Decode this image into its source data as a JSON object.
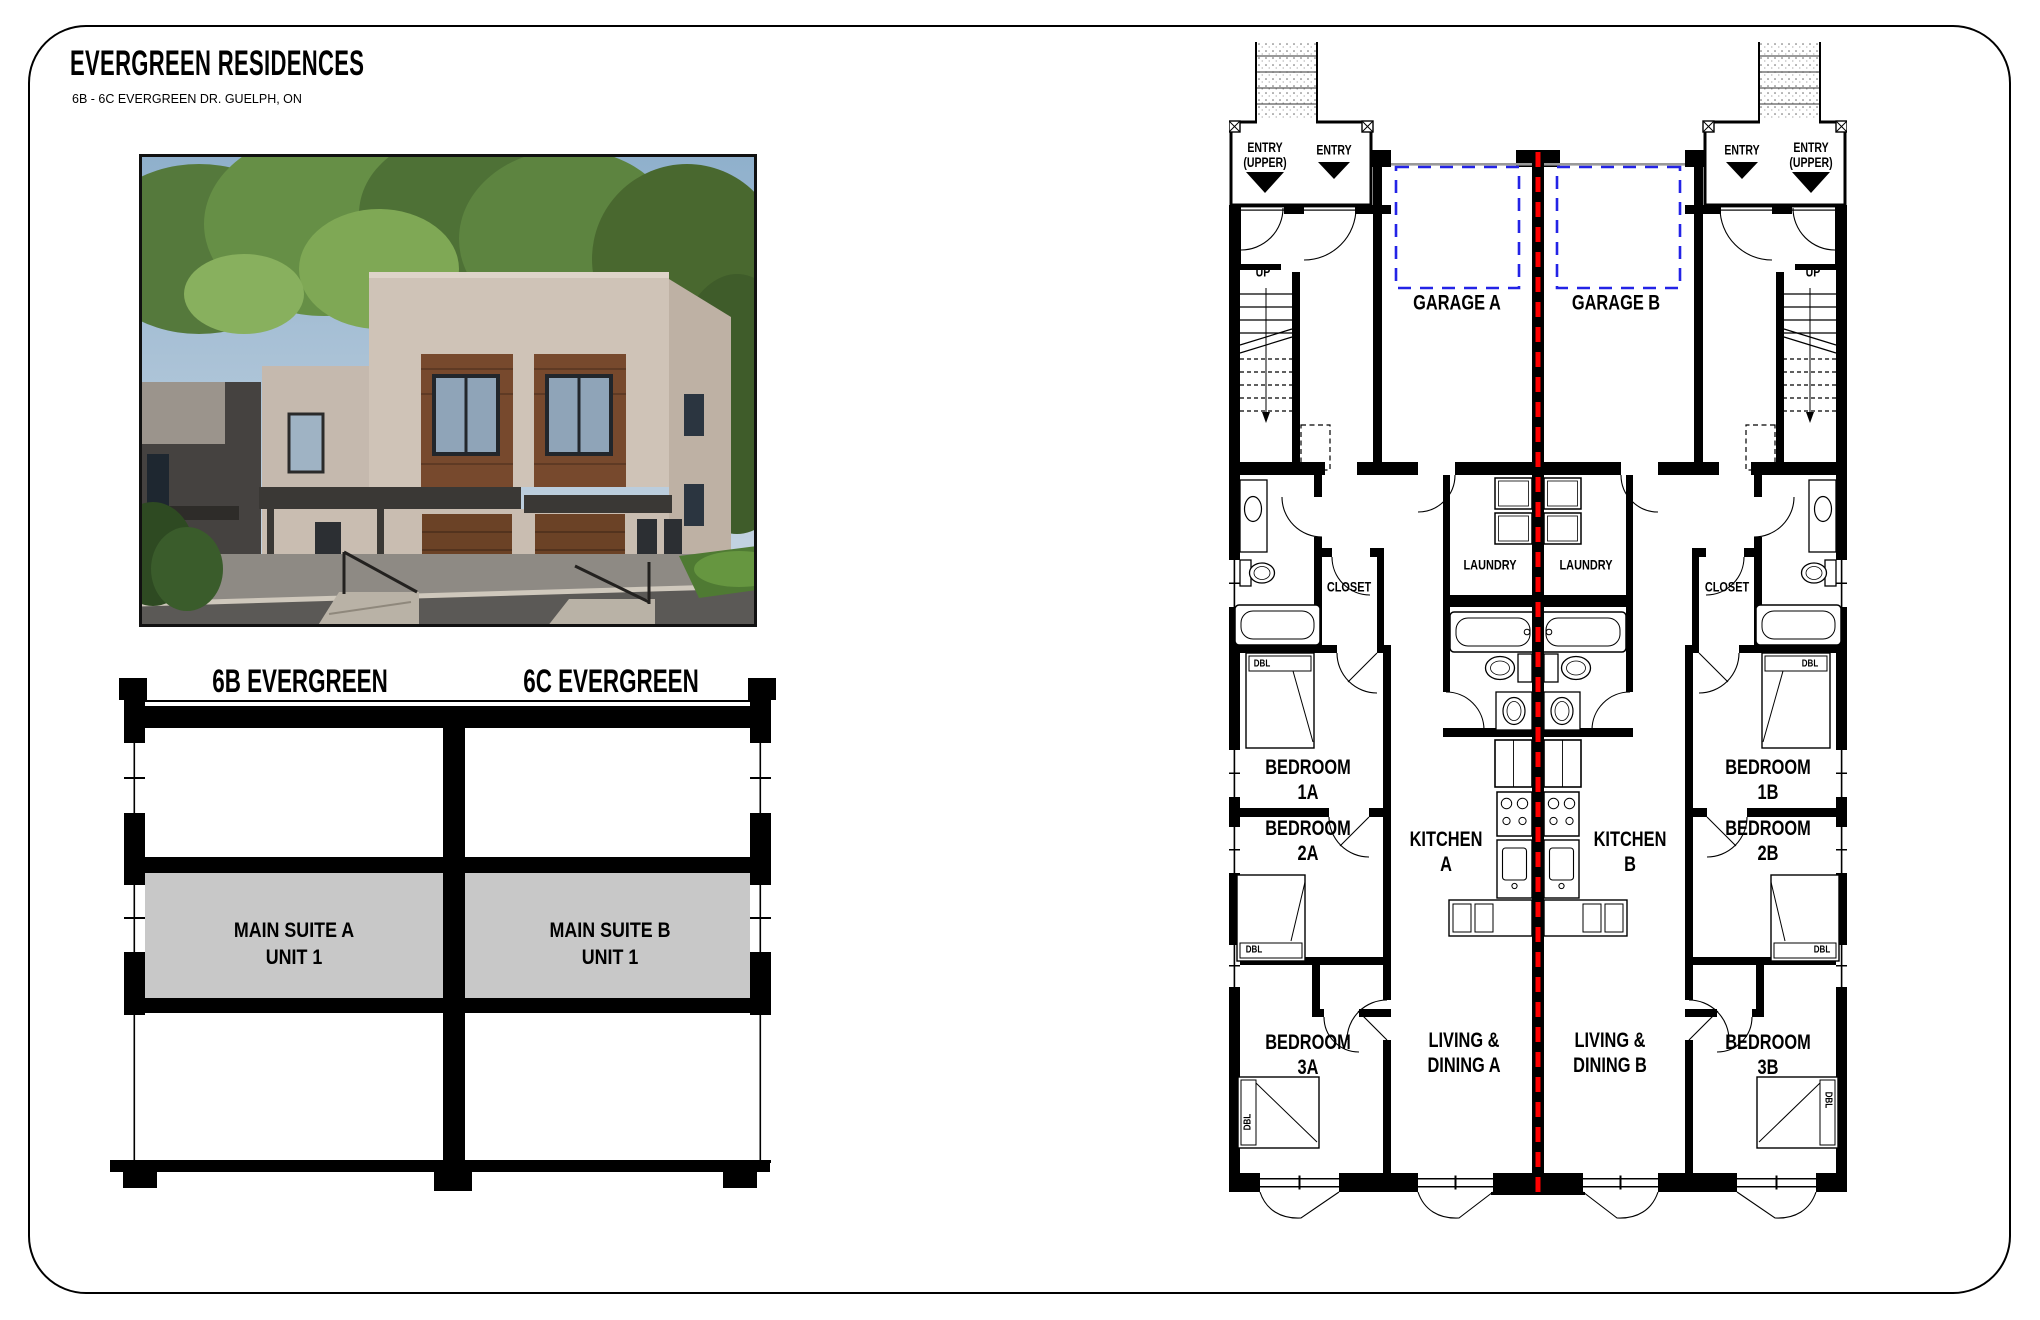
{
  "page": {
    "title": "EVERGREEN RESIDENCES",
    "subtitle": "6B - 6C EVERGREEN DR. GUELPH, ON"
  },
  "section": {
    "unit_b_label": "6B EVERGREEN",
    "unit_c_label": "6C EVERGREEN",
    "suite_a": [
      "MAIN SUITE A",
      "UNIT 1"
    ],
    "suite_b": [
      "MAIN SUITE B",
      "UNIT 1"
    ],
    "floor_fill_color": "#c8c8c8"
  },
  "plan": {
    "party_wall_line_color": "#ff0000",
    "garage_door_dash_color": "#2323e6",
    "labels": {
      "entry": "ENTRY",
      "entry_upper": [
        "ENTRY",
        "(UPPER)"
      ],
      "up": "UP",
      "garage_a": "GARAGE A",
      "garage_b": "GARAGE B",
      "laundry": "LAUNDRY",
      "closet": "CLOSET",
      "bedroom_1a": [
        "BEDROOM",
        "1A"
      ],
      "bedroom_1b": [
        "BEDROOM",
        "1B"
      ],
      "bedroom_2a": [
        "BEDROOM",
        "2A"
      ],
      "bedroom_2b": [
        "BEDROOM",
        "2B"
      ],
      "bedroom_3a": [
        "BEDROOM",
        "3A"
      ],
      "bedroom_3b": [
        "BEDROOM",
        "3B"
      ],
      "kitchen_a": [
        "KITCHEN",
        "A"
      ],
      "kitchen_b": [
        "KITCHEN",
        "B"
      ],
      "living_a": [
        "LIVING &",
        "DINING A"
      ],
      "living_b": [
        "LIVING &",
        "DINING B"
      ],
      "bed_size_tag": "DBL"
    }
  }
}
